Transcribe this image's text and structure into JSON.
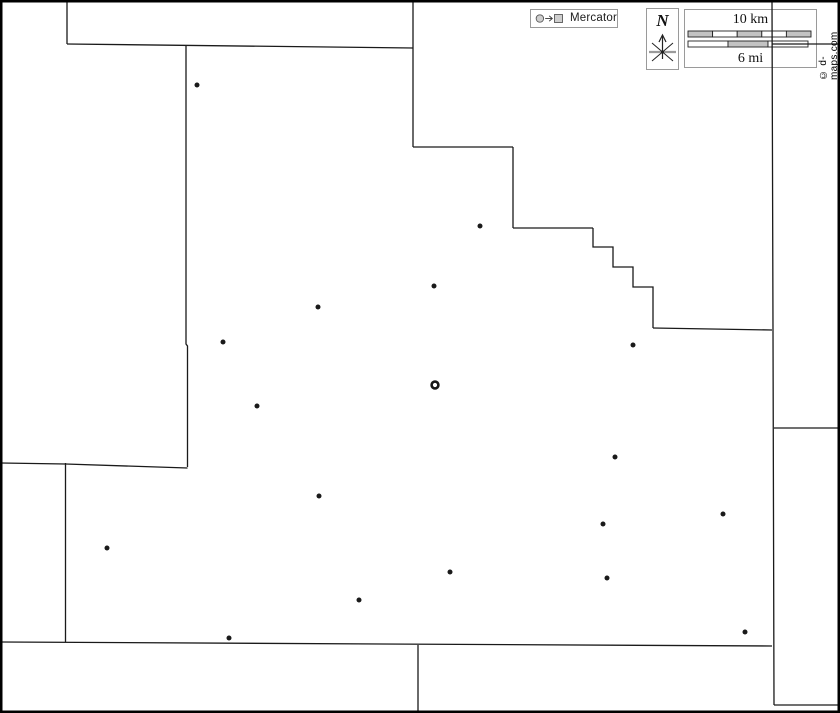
{
  "legend": {
    "label": "Mercator",
    "symbols": [
      "city-circle",
      "arrow",
      "town-square"
    ]
  },
  "compass": {
    "label": "N"
  },
  "scalebar": {
    "km_label": "10 km",
    "mi_label": "6 mi",
    "km_bar": {
      "length": 123,
      "height": 6,
      "fills": [
        "gray",
        "white",
        "gray",
        "white",
        "gray"
      ]
    },
    "mi_bar": {
      "length": 120,
      "height": 6,
      "fills": [
        "white",
        "gray",
        "white"
      ]
    }
  },
  "watermark": {
    "text": "© d-maps.com"
  },
  "colors": {
    "background": "#ffffff",
    "line": "#1a1a1a",
    "frame": "#000000",
    "box_border": "#9a9a9a",
    "bar_gray": "#c3c3c3",
    "bar_white": "#ffffff",
    "symbol_gray": "#cecece",
    "symbol_border": "#555555"
  },
  "map": {
    "width": 840,
    "height": 713,
    "boundaries": [
      [
        [
          67,
          1
        ],
        [
          67,
          44
        ]
      ],
      [
        [
          67,
          44
        ],
        [
          413,
          48
        ]
      ],
      [
        [
          413,
          1
        ],
        [
          413,
          147
        ]
      ],
      [
        [
          413,
          147
        ],
        [
          513,
          147
        ]
      ],
      [
        [
          513,
          147
        ],
        [
          513,
          228
        ]
      ],
      [
        [
          513,
          228
        ],
        [
          593,
          228
        ]
      ],
      [
        [
          593,
          228
        ],
        [
          593,
          247
        ],
        [
          613,
          247
        ],
        [
          613,
          267
        ],
        [
          633,
          267
        ],
        [
          633,
          287
        ],
        [
          653,
          287
        ],
        [
          653,
          328
        ]
      ],
      [
        [
          653,
          328
        ],
        [
          772,
          330
        ]
      ],
      [
        [
          772,
          1
        ],
        [
          773,
          330
        ],
        [
          774,
          705
        ]
      ],
      [
        [
          772,
          44
        ],
        [
          839,
          44
        ]
      ],
      [
        [
          774,
          428
        ],
        [
          839,
          428
        ]
      ],
      [
        [
          774,
          705
        ],
        [
          839,
          705
        ]
      ],
      [
        [
          186,
          46
        ],
        [
          186,
          344
        ],
        [
          187.5,
          346
        ],
        [
          187.5,
          467
        ]
      ],
      [
        [
          1,
          463
        ],
        [
          65.5,
          464
        ],
        [
          187.5,
          468
        ]
      ],
      [
        [
          65.5,
          463
        ],
        [
          65.5,
          642
        ]
      ],
      [
        [
          1,
          642
        ],
        [
          772,
          646
        ]
      ],
      [
        [
          418,
          645
        ],
        [
          418,
          712
        ]
      ]
    ],
    "cities": [
      [
        197,
        85
      ],
      [
        480,
        226
      ],
      [
        434,
        286
      ],
      [
        318,
        307
      ],
      [
        223,
        342
      ],
      [
        633,
        345
      ],
      [
        257,
        406
      ],
      [
        615,
        457
      ],
      [
        319,
        496
      ],
      [
        723,
        514
      ],
      [
        603,
        524
      ],
      [
        107,
        548
      ],
      [
        450,
        572
      ],
      [
        607,
        578
      ],
      [
        359,
        600
      ],
      [
        229,
        638
      ],
      [
        745,
        632
      ]
    ],
    "seat": {
      "x": 435,
      "y": 385
    }
  }
}
